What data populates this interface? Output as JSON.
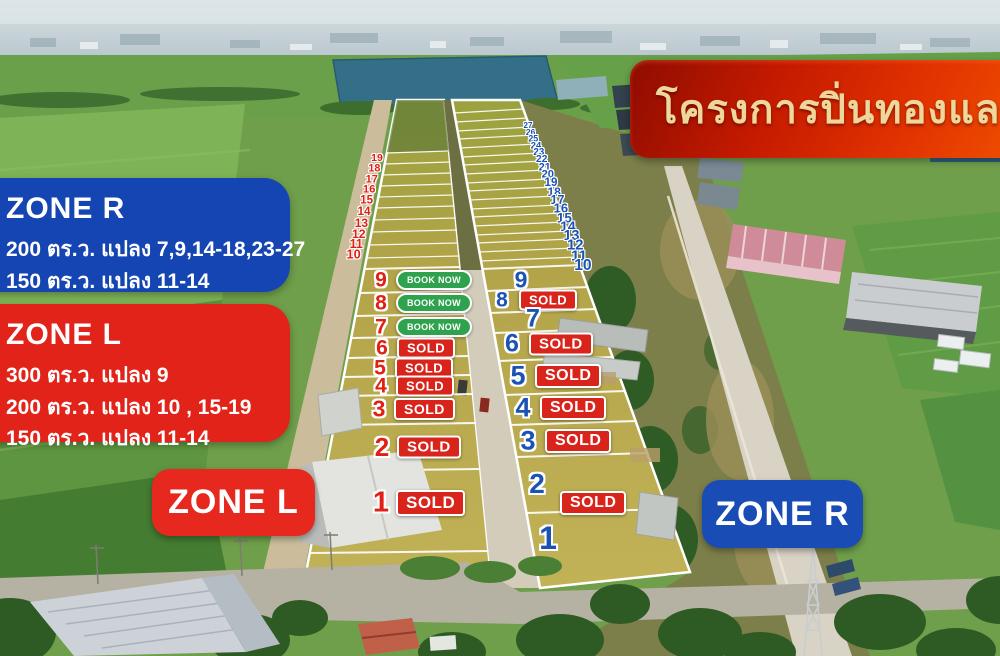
{
  "banner": {
    "title": "โครงการปิ่นทองแลนด์"
  },
  "info_boxes": {
    "zone_r": {
      "title": "ZONE R",
      "lines": [
        "200 ตร.ว. แปลง 7,9,14-18,23-27",
        "150 ตร.ว.  แปลง 11-14"
      ]
    },
    "zone_l": {
      "title": "ZONE L",
      "lines": [
        "300 ตร.ว. แปลง 9",
        "200 ตร.ว. แปลง 10 , 15-19",
        "150 ตร.ว.  แปลง 11-14"
      ]
    }
  },
  "zone_badges": {
    "left": "ZONE L",
    "right": "ZONE R"
  },
  "badge_labels": {
    "sold": "SOLD",
    "book_now": "BOOK NOW"
  },
  "colors": {
    "zone_l_red": "#e2231a",
    "zone_r_blue": "#1545b2",
    "sold_red": "#d9241c",
    "book_now_green": "#2fa24d",
    "banner_red": "#d42300",
    "banner_gold": "#eed79b",
    "left_number_red": "#e02015",
    "right_number_blue": "#1b53b5"
  },
  "map": {
    "left_strip": {
      "zone": "L",
      "plots": [
        {
          "no": "9",
          "status": "book_now",
          "x": 381,
          "y": 280
        },
        {
          "no": "8",
          "status": "book_now",
          "x": 381,
          "y": 303
        },
        {
          "no": "7",
          "status": "book_now",
          "x": 381,
          "y": 327
        },
        {
          "no": "6",
          "status": "sold",
          "x": 382,
          "y": 348
        },
        {
          "no": "5",
          "status": "sold",
          "x": 380,
          "y": 368
        },
        {
          "no": "4",
          "status": "sold",
          "x": 381,
          "y": 386
        },
        {
          "no": "3",
          "status": "sold",
          "x": 379,
          "y": 409
        },
        {
          "no": "2",
          "status": "sold",
          "x": 382,
          "y": 447
        },
        {
          "no": "1",
          "status": "sold",
          "x": 381,
          "y": 503
        }
      ],
      "row_numbers": [
        "19",
        "18",
        "17",
        "16",
        "15",
        "14",
        "13",
        "12",
        "11",
        "10"
      ]
    },
    "right_strip": {
      "zone": "R",
      "plots": [
        {
          "no": "9",
          "status": null,
          "x": 521,
          "y": 280
        },
        {
          "no": "8",
          "status": "sold",
          "x": 502,
          "y": 300
        },
        {
          "no": "7",
          "status": null,
          "x": 533,
          "y": 319
        },
        {
          "no": "6",
          "status": "sold",
          "x": 512,
          "y": 344
        },
        {
          "no": "5",
          "status": "sold",
          "x": 518,
          "y": 376
        },
        {
          "no": "4",
          "status": "sold",
          "x": 523,
          "y": 408
        },
        {
          "no": "3",
          "status": "sold",
          "x": 528,
          "y": 441
        },
        {
          "no": "2",
          "status": "sold",
          "x": 537,
          "y": 484,
          "bx": 560,
          "by": 503
        },
        {
          "no": "1",
          "status": null,
          "x": 548,
          "y": 538
        }
      ],
      "row_numbers": [
        "27",
        "26",
        "25",
        "24",
        "23",
        "22",
        "21",
        "20",
        "19",
        "18",
        "17",
        "16",
        "15",
        "14",
        "13",
        "12",
        "11",
        "10"
      ]
    }
  }
}
